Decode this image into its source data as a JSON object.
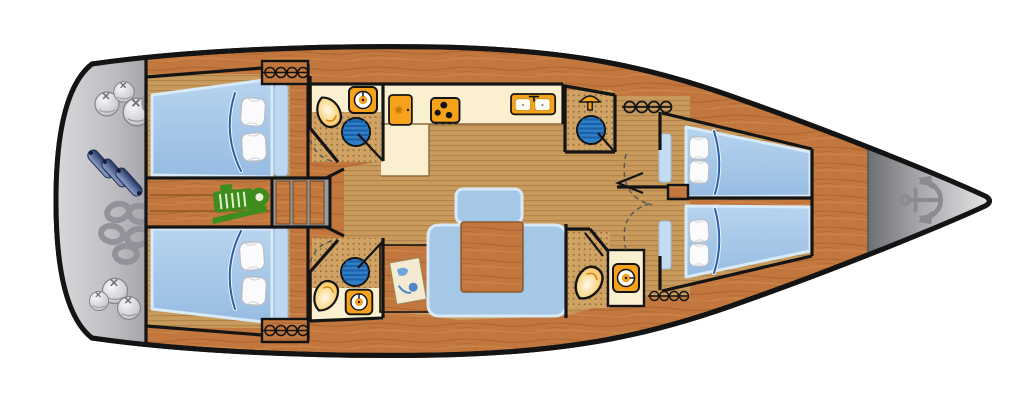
{
  "canvas": {
    "width": 1024,
    "height": 403,
    "background": "#ffffff"
  },
  "subject": {
    "type": "sailing-yacht-interior-deck-plan",
    "view": "top-down",
    "bow_direction": "right",
    "cabin_count": 4,
    "head_count": 4,
    "berth_count": 4,
    "deck_hatch_count": 4,
    "companionway_steps": 3,
    "stove_burners": 3
  },
  "colors": {
    "hull_outline": "#141414",
    "deck_wood": "#c1773d",
    "teak_floor": "#c89a5c",
    "tile_floor": "#d0a364",
    "counter_cream": "#faf0cf",
    "bed_blue": "#a6c8e7",
    "bed_edge": "#d8e9f7",
    "blanket_fold": "#2b5fa8",
    "pillow_white": "#fbfbfd",
    "fixture_orange": "#f6a21d",
    "sink_blue": "#2e7fc5",
    "engine_green": "#3e8c1c",
    "platform_gray": "#c2c2c6",
    "anchor_gray": "#8b8b90",
    "fender_blue": "#5a6d9c",
    "rope_gray": "#94949a",
    "riser_gray": "#9a9a9a",
    "map_paper": "#f3ebd1",
    "map_blue": "#6ea6dc"
  },
  "regions": {
    "stern_platform": {
      "icons": [
        "ball-fender-icon",
        "rope-figure8-icon",
        "cylinder-fender-icon",
        "rope-coil-icon",
        "ball-fender-icon"
      ]
    },
    "aft_cabin_port": {
      "items": [
        "double-berth",
        "pillow",
        "pillow"
      ]
    },
    "aft_cabin_starboard": {
      "items": [
        "double-berth",
        "pillow",
        "pillow"
      ]
    },
    "engine_room": {
      "icons": [
        "engine-icon"
      ]
    },
    "companionway": {
      "step_count": 3
    },
    "head_aft_port": {
      "icons": [
        "washing-machine-icon",
        "toilet-icon",
        "washbasin-icon"
      ]
    },
    "head_aft_starboard": {
      "icons": [
        "washbasin-icon",
        "toilet-icon",
        "washing-machine-icon"
      ]
    },
    "galley": {
      "icons": [
        "fridge-icon",
        "stove-icon",
        "double-sink-icon"
      ]
    },
    "salon": {
      "items": [
        "u-settee",
        "dining-table",
        "bench-seat",
        "nav-desk",
        "sea-chart"
      ]
    },
    "shower_room_forward": {
      "icons": [
        "shower-icon",
        "washbasin-icon"
      ]
    },
    "head_forward": {
      "icons": [
        "toilet-icon",
        "washing-machine-icon"
      ]
    },
    "fore_cabin_port": {
      "items": [
        "double-berth",
        "pillow",
        "pillow"
      ]
    },
    "fore_cabin_starboard": {
      "items": [
        "double-berth",
        "pillow",
        "pillow"
      ]
    },
    "bow": {
      "icons": [
        "anchor-icon"
      ]
    }
  }
}
